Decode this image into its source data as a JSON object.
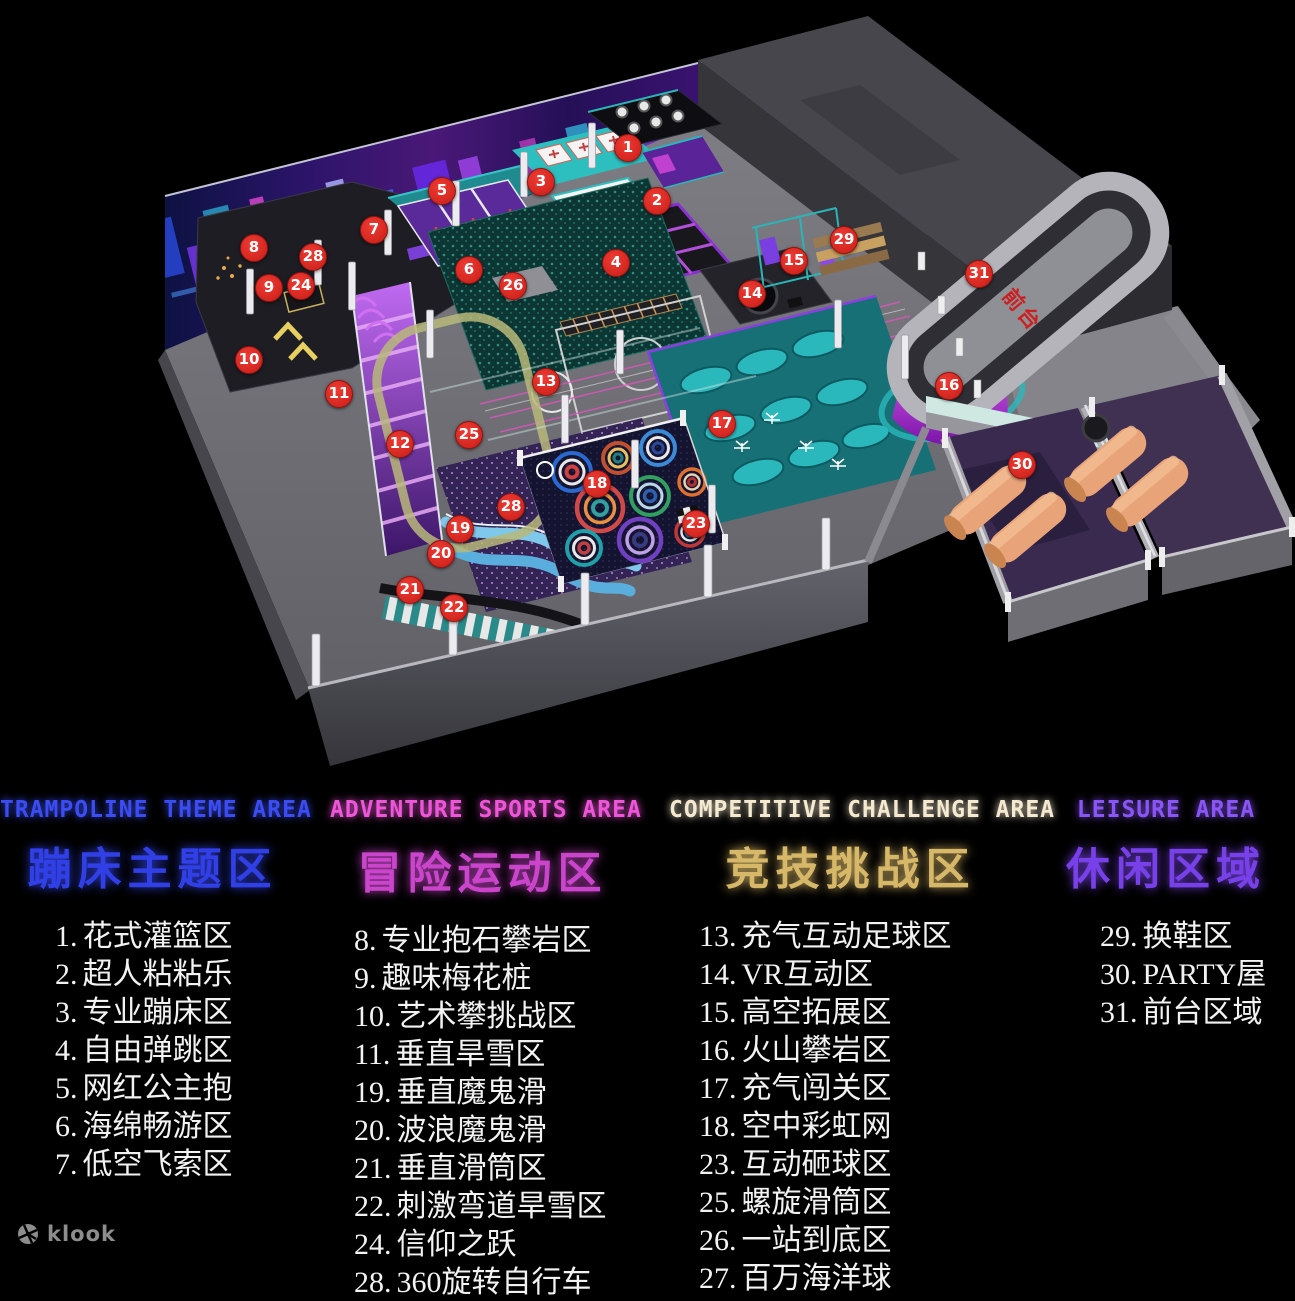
{
  "watermark": {
    "brand": "klook"
  },
  "map": {
    "oval_label": "前台",
    "markers": [
      {
        "n": "1",
        "x": 627,
        "y": 147
      },
      {
        "n": "2",
        "x": 656,
        "y": 200
      },
      {
        "n": "3",
        "x": 540,
        "y": 181
      },
      {
        "n": "4",
        "x": 615,
        "y": 262
      },
      {
        "n": "5",
        "x": 441,
        "y": 190
      },
      {
        "n": "6",
        "x": 468,
        "y": 269
      },
      {
        "n": "7",
        "x": 373,
        "y": 229
      },
      {
        "n": "8",
        "x": 253,
        "y": 247
      },
      {
        "n": "9",
        "x": 268,
        "y": 287
      },
      {
        "n": "10",
        "x": 248,
        "y": 359
      },
      {
        "n": "11",
        "x": 338,
        "y": 393
      },
      {
        "n": "12",
        "x": 399,
        "y": 443
      },
      {
        "n": "13",
        "x": 545,
        "y": 381
      },
      {
        "n": "14",
        "x": 751,
        "y": 293
      },
      {
        "n": "15",
        "x": 793,
        "y": 260
      },
      {
        "n": "16",
        "x": 948,
        "y": 385
      },
      {
        "n": "17",
        "x": 721,
        "y": 423
      },
      {
        "n": "18",
        "x": 596,
        "y": 483
      },
      {
        "n": "19",
        "x": 459,
        "y": 528
      },
      {
        "n": "20",
        "x": 440,
        "y": 553
      },
      {
        "n": "21",
        "x": 409,
        "y": 589
      },
      {
        "n": "22",
        "x": 453,
        "y": 607
      },
      {
        "n": "23",
        "x": 695,
        "y": 523
      },
      {
        "n": "24",
        "x": 300,
        "y": 285
      },
      {
        "n": "25",
        "x": 468,
        "y": 434
      },
      {
        "n": "26",
        "x": 512,
        "y": 285
      },
      {
        "n": "28",
        "x": 312,
        "y": 256
      },
      {
        "n": "28",
        "x": 510,
        "y": 506
      },
      {
        "n": "29",
        "x": 843,
        "y": 239
      },
      {
        "n": "30",
        "x": 1021,
        "y": 464
      },
      {
        "n": "31",
        "x": 978,
        "y": 273
      }
    ]
  },
  "legend": {
    "sections": [
      {
        "en": "TRAMPOLINE THEME AREA",
        "cn": "蹦床主题区",
        "en_color": "#3a4cf2",
        "cn_color": "#3140e6",
        "items": [
          {
            "num": "1.",
            "label": "花式灌篮区"
          },
          {
            "num": "2.",
            "label": "超人粘粘乐"
          },
          {
            "num": "3.",
            "label": "专业蹦床区"
          },
          {
            "num": "4.",
            "label": "自由弹跳区"
          },
          {
            "num": "5.",
            "label": "网红公主抱"
          },
          {
            "num": "6.",
            "label": "海绵畅游区"
          },
          {
            "num": "7.",
            "label": "低空飞索区"
          }
        ]
      },
      {
        "en": "ADVENTURE SPORTS AREA",
        "cn": "冒险运动区",
        "en_color": "#ee55d8",
        "cn_color": "#cb45cc",
        "items": [
          {
            "num": "8.",
            "label": "专业抱石攀岩区"
          },
          {
            "num": "9.",
            "label": "趣味梅花桩"
          },
          {
            "num": "10.",
            "label": "艺术攀挑战区"
          },
          {
            "num": "11.",
            "label": "垂直旱雪区"
          },
          {
            "num": "19.",
            "label": "垂直魔鬼滑"
          },
          {
            "num": "20.",
            "label": "波浪魔鬼滑"
          },
          {
            "num": "21.",
            "label": "垂直滑筒区"
          },
          {
            "num": "22.",
            "label": "刺激弯道旱雪区"
          },
          {
            "num": "24.",
            "label": "信仰之跃"
          },
          {
            "num": "28.",
            "label": "360旋转自行车"
          }
        ]
      },
      {
        "en": "COMPETITIVE CHALLENGE AREA",
        "cn": "竞技挑战区",
        "en_color": "#f5ead0",
        "cn_color": "#d7b768",
        "items": [
          {
            "num": "13.",
            "label": "充气互动足球区"
          },
          {
            "num": "14.",
            "label": "VR互动区"
          },
          {
            "num": "15.",
            "label": "高空拓展区"
          },
          {
            "num": "16.",
            "label": "火山攀岩区"
          },
          {
            "num": "17.",
            "label": "充气闯关区"
          },
          {
            "num": "18.",
            "label": "空中彩虹网"
          },
          {
            "num": "23.",
            "label": "互动砸球区"
          },
          {
            "num": "25.",
            "label": "螺旋滑筒区"
          },
          {
            "num": "26.",
            "label": "一站到底区"
          },
          {
            "num": "27.",
            "label": "百万海洋球"
          }
        ]
      },
      {
        "en": "LEISURE AREA",
        "cn": "休闲区域",
        "en_color": "#8a55f6",
        "cn_color": "#7840e8",
        "items": [
          {
            "num": "29.",
            "label": "换鞋区"
          },
          {
            "num": "30.",
            "label": "PARTY屋"
          },
          {
            "num": "31.",
            "label": "前台区域"
          }
        ]
      }
    ]
  }
}
